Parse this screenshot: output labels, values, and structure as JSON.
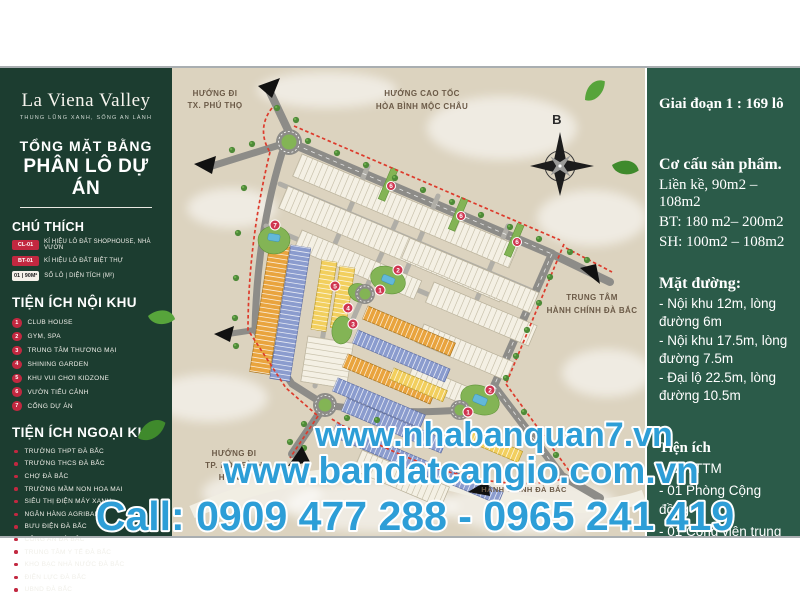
{
  "brand": {
    "name": "La Viena Valley",
    "tagline": "THUNG LŨNG XANH, SỐNG AN LÀNH"
  },
  "title": {
    "line1": "TỔNG MẶT BẰNG",
    "line2": "PHÂN LÔ DỰ ÁN"
  },
  "legend": {
    "heading": "CHÚ THÍCH",
    "items": [
      {
        "badge": "CL-01",
        "label": "KÍ HIỆU LÔ ĐẤT SHOPHOUSE, NHÀ VƯỜN"
      },
      {
        "badge": "BT-01",
        "label": "KÍ HIỆU LÔ ĐẤT BIỆT THỰ"
      },
      {
        "badge": "01 | 90M²",
        "label": "SỐ LÔ  |  DIỆN TÍCH (M²)"
      }
    ]
  },
  "noi_khu": {
    "heading": "TIỆN ÍCH NỘI KHU",
    "items": [
      {
        "num": "1",
        "label": "CLUB HOUSE"
      },
      {
        "num": "2",
        "label": "GYM, SPA"
      },
      {
        "num": "3",
        "label": "TRUNG TÂM THƯƠNG MẠI"
      },
      {
        "num": "4",
        "label": "SHINING GARDEN"
      },
      {
        "num": "5",
        "label": "KHU VUI CHƠI KIDZONE"
      },
      {
        "num": "6",
        "label": "VƯỜN TIỂU CẢNH"
      },
      {
        "num": "7",
        "label": "CỔNG DỰ ÁN"
      }
    ]
  },
  "ngoai_khu": {
    "heading": "TIỆN ÍCH NGOẠI KHU",
    "items": [
      "TRƯỜNG THPT ĐÀ BẮC",
      "TRƯỜNG THCS ĐÀ BẮC",
      "CHỢ ĐÀ BẮC",
      "TRƯỜNG MẦM NON HOA MAI",
      "SIÊU THỊ ĐIỆN MÁY XANH",
      "NGÂN HÀNG AGRIBANK",
      "BƯU ĐIỆN ĐÀ BẮC",
      "CÔNG AN ĐÀ BẮC",
      "TRUNG TÂM Y TẾ ĐÀ BẮC",
      "KHO BẠC NHÀ NƯỚC ĐÀ BẮC",
      "ĐIỆN LỰC ĐÀ BẮC",
      "UBND ĐÀ BẮC"
    ]
  },
  "map": {
    "compass": "B",
    "labels": {
      "phu_tho": [
        "HƯỚNG ĐI",
        "TX. PHÚ THỌ"
      ],
      "cao_toc": [
        "HƯỚNG CAO TỐC",
        "HÒA BÌNH MỘC CHÂU"
      ],
      "trung_tam": [
        "TRUNG TÂM",
        "HÀNH CHÍNH ĐÀ BẮC"
      ],
      "hoa_binh": [
        "HƯỚNG ĐI",
        "TP. HÒA BÌNH",
        "HÀ NỘI"
      ],
      "hanh_chinh_bottom": "HÀNH CHÍNH ĐÀ BẮC"
    },
    "markers": [
      "1",
      "2",
      "3",
      "4",
      "5",
      "6",
      "7"
    ]
  },
  "info_panel": {
    "phase": "Giai đoạn 1 : 169 lô",
    "structure_heading": "Cơ cấu sản phẩm.",
    "structure_lines": [
      "Liền kề, 90m2 – 108m2",
      "BT: 180 m2– 200m2",
      "SH: 100m2 – 108m2"
    ],
    "road_heading": "Mặt đường:",
    "road_lines": [
      "- Nội khu 12m, lòng đường 6m",
      "- Nội khu 17.5m, lòng đường 7.5m",
      "- Đại lộ 22.5m, lòng đường 10.5m"
    ],
    "amenity_heading": "Tiện ích",
    "amenity_lines": [
      "- 02 TTTM",
      "- 01 Phòng Cộng đồng",
      "- 01 Công viên trung tâm"
    ]
  },
  "watermark": {
    "line1": "www.nhabanquan7.vn",
    "line2": "www.bandatcangio.com.vn",
    "line3": "Call: 0909 477 288 - 0965 241 419"
  },
  "colors": {
    "panel_green_left": "#1C3D30",
    "panel_green_right": "#2B5B49",
    "map_beige": "#DCD3BF",
    "accent_red": "#C22840",
    "boundary_red": "#DD3B2C",
    "watermark_blue": "#2D9ED7",
    "lot_orange": "#E9A43E",
    "lot_blue": "#8B9CCE",
    "lot_yellow": "#F2CF5E"
  }
}
